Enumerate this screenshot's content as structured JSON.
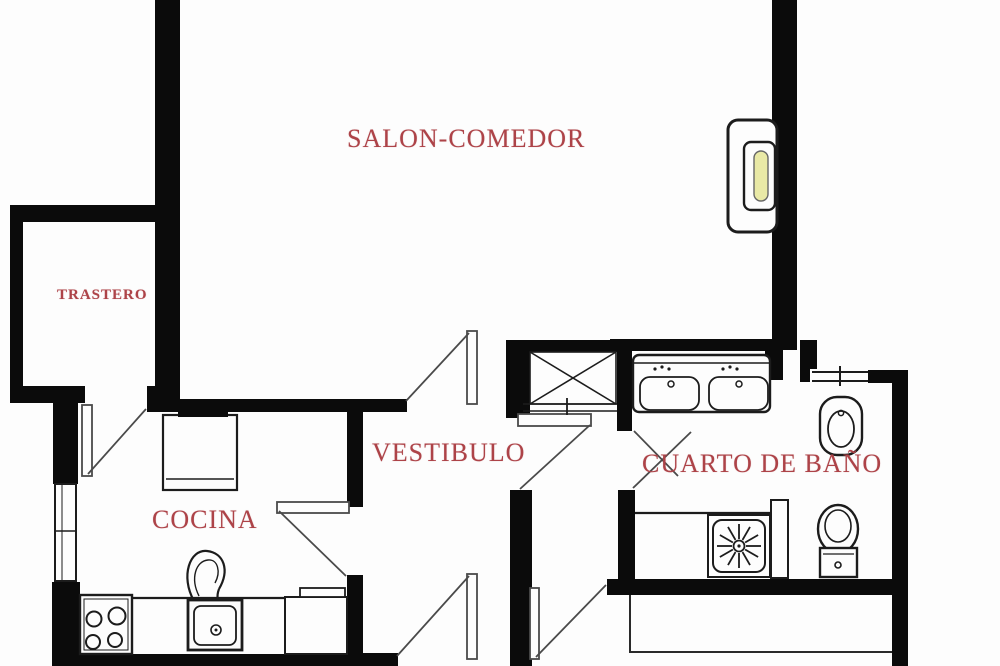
{
  "title": "Apartment floor plan",
  "rooms": {
    "salon": {
      "label": "SALON-COMEDOR"
    },
    "trastero": {
      "label": "TRASTERO"
    },
    "cocina": {
      "label": "COCINA"
    },
    "vestibulo": {
      "label": "VESTIBULO"
    },
    "bano": {
      "label": "CUARTO DE BAÑO"
    }
  },
  "fixtures": {
    "salon": [
      "wall-radiator"
    ],
    "cocina": [
      "fridge",
      "counter",
      "stove-4-burners",
      "sink-with-faucet",
      "under-counter-appliance",
      "window"
    ],
    "vestibulo": [
      "built-in-wardrobe-x",
      "entrance-doors"
    ],
    "bano": [
      "double-sink-vanity",
      "bidet",
      "toilet",
      "shower-tray-with-drain-star",
      "shower-screen",
      "window"
    ],
    "exterior": [
      "terrace-outline"
    ]
  },
  "colors": {
    "background": "#fdfdfd",
    "walls": "#0b0b0b",
    "labels": "#ad4348",
    "fixture_lines": "#1c1c1c",
    "door_lines": "#4a4a4a",
    "radiator_panel": "#e9e9a6"
  }
}
